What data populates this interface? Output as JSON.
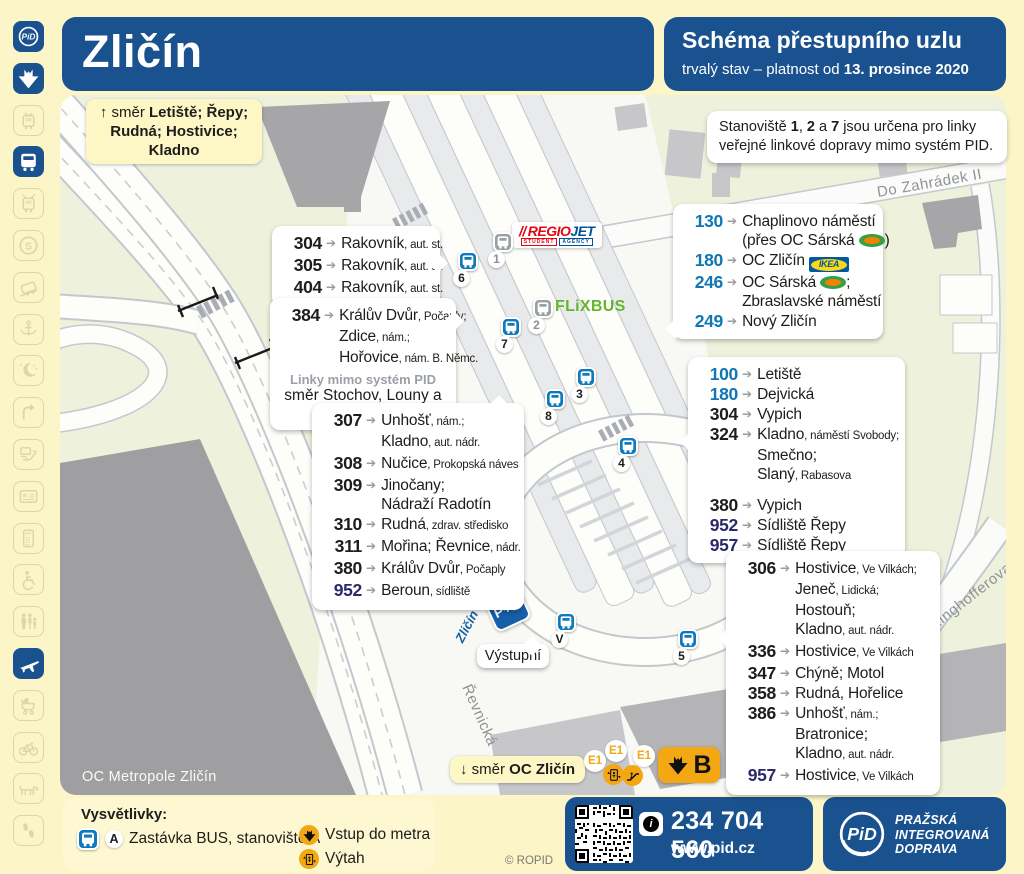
{
  "header": {
    "station": "Zličín",
    "title": "Schéma přestupního uzlu",
    "subtitle_prefix": "trvalý stav – platnost od ",
    "subtitle_date": "13. prosince 2020"
  },
  "sidebar": {
    "icons": [
      {
        "name": "pid-logo-icon",
        "active": true
      },
      {
        "name": "metro-icon",
        "active": true
      },
      {
        "name": "tram-icon",
        "active": false
      },
      {
        "name": "bus-icon",
        "active": true
      },
      {
        "name": "trolleybus-icon",
        "active": false
      },
      {
        "name": "train-icon",
        "active": false
      },
      {
        "name": "funicular-icon",
        "active": false
      },
      {
        "name": "ferry-icon",
        "active": false
      },
      {
        "name": "night-service-icon",
        "active": false
      },
      {
        "name": "turnback-icon",
        "active": false
      },
      {
        "name": "ticket-sale-icon",
        "active": false
      },
      {
        "name": "card-icon",
        "active": false
      },
      {
        "name": "mobile-icon",
        "active": false
      },
      {
        "name": "wheelchair-icon",
        "active": false
      },
      {
        "name": "family-icon",
        "active": false
      },
      {
        "name": "airport-icon",
        "active": true
      },
      {
        "name": "pram-icon",
        "active": false
      },
      {
        "name": "bike-icon",
        "active": false
      },
      {
        "name": "dog-icon",
        "active": false
      },
      {
        "name": "walking-icon",
        "active": false
      }
    ]
  },
  "map": {
    "streets": {
      "do_zahradek": "Do Zahrádek II",
      "ringhofferova": "Ringhofferova",
      "revnicka": "Řevnická"
    },
    "building_label": "OC Metropole Zličín",
    "direction_up": {
      "prefix": "↑ směr ",
      "bold1": "Letiště; Řepy;",
      "bold2": "Rudná; Hostivice; Kladno"
    },
    "direction_down": {
      "prefix": "↓ směr ",
      "bold1": "OC Zličín"
    },
    "note": {
      "line1": [
        {
          "t": "Stanoviště "
        },
        {
          "t": "1",
          "b": 1
        },
        {
          "t": ", "
        },
        {
          "t": "2",
          "b": 1
        },
        {
          "t": " a "
        },
        {
          "t": "7",
          "b": 1
        },
        {
          "t": " jsou určena pro linky"
        }
      ],
      "line2": [
        {
          "t": "veřejné linkové dopravy mimo systém PID."
        }
      ]
    },
    "exit_label": "Výstupní",
    "pr_sign": {
      "label": "P+R",
      "name": "Zličín I."
    },
    "metro_entrance": {
      "line": "B",
      "exit_badges": [
        "E1",
        "E1",
        "E1"
      ]
    },
    "operators": {
      "regiojet": {
        "slashes": "//",
        "part1": "REGIO",
        "part2": "JET",
        "tag1": "STUDENT",
        "tag2": "AGENCY"
      },
      "flixbus": "FLiXBUS",
      "ikea": "IKEA"
    },
    "stops": [
      {
        "label": "6",
        "x": 408,
        "y": 166,
        "variant": "pid"
      },
      {
        "label": "1",
        "x": 443,
        "y": 147,
        "variant": "ext"
      },
      {
        "label": "7",
        "x": 451,
        "y": 232,
        "variant": "pid"
      },
      {
        "label": "2",
        "x": 483,
        "y": 213,
        "variant": "ext"
      },
      {
        "label": "3",
        "x": 526,
        "y": 282,
        "variant": "pid"
      },
      {
        "label": "8",
        "x": 495,
        "y": 304,
        "variant": "pid"
      },
      {
        "label": "4",
        "x": 568,
        "y": 351,
        "variant": "pid"
      },
      {
        "label": "V",
        "x": 506,
        "y": 527,
        "variant": "pid"
      },
      {
        "label": "5",
        "x": 628,
        "y": 544,
        "variant": "pid"
      }
    ],
    "panels": [
      {
        "id": "rakovnik-group",
        "x": 212,
        "y": 131,
        "w": 168,
        "pointer": {
          "side": "right",
          "top": 30
        },
        "routes": [
          {
            "n": "304",
            "c": "sub",
            "lines": [
              [
                {
                  "t": "Rakovník"
                },
                {
                  "t": ", aut. st.",
                  "sm": 1
                }
              ]
            ]
          },
          {
            "n": "305",
            "c": "sub",
            "lines": [
              [
                {
                  "t": "Rakovník"
                },
                {
                  "t": ", aut. st.",
                  "sm": 1
                }
              ]
            ]
          },
          {
            "n": "404",
            "c": "sub",
            "lines": [
              [
                {
                  "t": "Rakovník"
                },
                {
                  "t": ", aut. st.",
                  "sm": 1
                }
              ]
            ]
          }
        ]
      },
      {
        "id": "kraluv-dvur-group",
        "x": 210,
        "y": 203,
        "w": 186,
        "pointer": {
          "side": "right",
          "top": 16
        },
        "routes": [
          {
            "n": "384",
            "c": "sub",
            "lines": [
              [
                {
                  "t": "Králův Dvůr"
                },
                {
                  "t": ", Počaply;",
                  "sm": 1
                }
              ],
              [
                {
                  "t": "Zdice"
                },
                {
                  "t": ", nám.;",
                  "sm": 1
                }
              ],
              [
                {
                  "t": "Hořovice"
                },
                {
                  "t": ", nám. B. Němc.",
                  "sm": 1
                }
              ]
            ]
          }
        ],
        "footnotes": [
          {
            "t": "Linky mimo systém PID",
            "cls": "fn-strong"
          },
          {
            "t": "směr Stochov, Louny a Žatec",
            "cls": "fn-plain"
          }
        ]
      },
      {
        "id": "west-suburban-group",
        "x": 252,
        "y": 308,
        "w": 212,
        "pointer": {
          "side": "top",
          "left": 180
        },
        "routes": [
          {
            "n": "307",
            "c": "sub",
            "lines": [
              [
                {
                  "t": "Unhošť"
                },
                {
                  "t": ", nám.;",
                  "sm": 1
                }
              ],
              [
                {
                  "t": "Kladno"
                },
                {
                  "t": ", aut. nádr.",
                  "sm": 1
                }
              ]
            ]
          },
          {
            "n": "308",
            "c": "sub",
            "lines": [
              [
                {
                  "t": "Nučice"
                },
                {
                  "t": ", Prokopská náves",
                  "sm": 1
                }
              ]
            ]
          },
          {
            "n": "309",
            "c": "sub",
            "lines": [
              [
                {
                  "t": "Jinočany;"
                }
              ],
              [
                {
                  "t": "Nádraží Radotín"
                }
              ]
            ]
          },
          {
            "n": "310",
            "c": "sub",
            "lines": [
              [
                {
                  "t": "Rudná"
                },
                {
                  "t": ", zdrav. středisko",
                  "sm": 1
                }
              ]
            ]
          },
          {
            "n": "311",
            "c": "sub",
            "lines": [
              [
                {
                  "t": "Mořina; Řevnice"
                },
                {
                  "t": ", nádr.",
                  "sm": 1
                }
              ]
            ]
          },
          {
            "n": "380",
            "c": "sub",
            "lines": [
              [
                {
                  "t": "Králův Dvůr"
                },
                {
                  "t": ", Počaply",
                  "sm": 1
                }
              ]
            ]
          },
          {
            "n": "952",
            "c": "night",
            "lines": [
              [
                {
                  "t": "Beroun"
                },
                {
                  "t": ", sídliště",
                  "sm": 1
                }
              ]
            ]
          }
        ]
      },
      {
        "id": "city-lines-north",
        "x": 613,
        "y": 109,
        "w": 210,
        "pointer": {
          "side": "left",
          "top": 118
        },
        "routes": [
          {
            "n": "130",
            "c": "city",
            "lines": [
              [
                {
                  "t": "Chaplinovo náměstí"
                }
              ],
              [
                {
                  "t": "(přes OC Sárská "
                },
                {
                  "logo": "globus"
                },
                {
                  "t": ")"
                }
              ]
            ]
          },
          {
            "n": "180",
            "c": "city",
            "lines": [
              [
                {
                  "t": "OC Zličín "
                },
                {
                  "logo": "ikea"
                }
              ]
            ]
          },
          {
            "n": "246",
            "c": "city",
            "lines": [
              [
                {
                  "t": "OC Sárská "
                },
                {
                  "logo": "globus"
                },
                {
                  "t": ";"
                }
              ],
              [
                {
                  "t": "Zbraslavské náměstí"
                }
              ]
            ]
          },
          {
            "n": "249",
            "c": "city",
            "lines": [
              [
                {
                  "t": "Nový Zličín"
                }
              ]
            ]
          }
        ]
      },
      {
        "id": "city-west-group",
        "x": 628,
        "y": 262,
        "w": 217,
        "pointer": {
          "side": "left",
          "top": 78
        },
        "routes": [
          {
            "n": "100",
            "c": "city",
            "lines": [
              [
                {
                  "t": "Letiště"
                }
              ]
            ]
          },
          {
            "n": "180",
            "c": "city",
            "lines": [
              [
                {
                  "t": "Dejvická"
                }
              ]
            ]
          },
          {
            "n": "304",
            "c": "sub",
            "lines": [
              [
                {
                  "t": "Vypich"
                }
              ]
            ]
          },
          {
            "n": "324",
            "c": "sub",
            "lines": [
              [
                {
                  "t": "Kladno"
                },
                {
                  "t": ", náměstí Svobody;",
                  "sm": 1
                }
              ],
              [
                {
                  "t": "Smečno;"
                }
              ],
              [
                {
                  "t": "Slaný"
                },
                {
                  "t": ", Rabasova",
                  "sm": 1
                }
              ]
            ]
          },
          {
            "n": "380",
            "c": "sub",
            "gap": 1,
            "lines": [
              [
                {
                  "t": "Vypich"
                }
              ]
            ]
          },
          {
            "n": "952",
            "c": "night",
            "lines": [
              [
                {
                  "t": "Sídliště Řepy"
                }
              ]
            ]
          },
          {
            "n": "957",
            "c": "night",
            "lines": [
              [
                {
                  "t": "Sídliště Řepy"
                }
              ]
            ]
          }
        ]
      },
      {
        "id": "south-suburban-group",
        "x": 666,
        "y": 456,
        "w": 214,
        "pointer": {
          "side": "left",
          "top": 80
        },
        "routes": [
          {
            "n": "306",
            "c": "sub",
            "lines": [
              [
                {
                  "t": "Hostivice"
                },
                {
                  "t": ", Ve Vilkách;",
                  "sm": 1
                }
              ],
              [
                {
                  "t": "Jeneč"
                },
                {
                  "t": ", Lidická;",
                  "sm": 1
                }
              ],
              [
                {
                  "t": "Hostouň;"
                }
              ],
              [
                {
                  "t": "Kladno"
                },
                {
                  "t": ", aut. nádr.",
                  "sm": 1
                }
              ]
            ]
          },
          {
            "n": "336",
            "c": "sub",
            "lines": [
              [
                {
                  "t": "Hostivice"
                },
                {
                  "t": ", Ve Vilkách",
                  "sm": 1
                }
              ]
            ]
          },
          {
            "n": "347",
            "c": "sub",
            "lines": [
              [
                {
                  "t": "Chýně; Motol"
                }
              ]
            ]
          },
          {
            "n": "358",
            "c": "sub",
            "lines": [
              [
                {
                  "t": "Rudná, Hořelice"
                }
              ]
            ]
          },
          {
            "n": "386",
            "c": "sub",
            "lines": [
              [
                {
                  "t": "Unhošť"
                },
                {
                  "t": ", nám.;",
                  "sm": 1
                }
              ],
              [
                {
                  "t": "Bratronice;"
                }
              ],
              [
                {
                  "t": "Kladno"
                },
                {
                  "t": ", aut. nádr.",
                  "sm": 1
                }
              ]
            ]
          },
          {
            "n": "957",
            "c": "night",
            "lines": [
              [
                {
                  "t": "Hostivice"
                },
                {
                  "t": ", Ve Vilkách",
                  "sm": 1
                }
              ]
            ]
          }
        ]
      }
    ]
  },
  "legend": {
    "title": "Vysvětlivky:",
    "items": [
      {
        "icon": "bus-stop",
        "badge": "A",
        "label": "Zastávka BUS, stanoviště A"
      },
      {
        "icon": "metro-entrance",
        "label": "Vstup do metra"
      },
      {
        "icon": "elevator",
        "label": "Výtah"
      }
    ]
  },
  "footer": {
    "copyright": "© ROPID",
    "phone": "234 704 560",
    "web": "www.pid.cz",
    "brand": [
      "PRAŽSKÁ",
      "INTEGROVANÁ",
      "DOPRAVA"
    ]
  },
  "colors": {
    "header_blue": "#1a518f",
    "bus_stop_blue": "#0e7abd",
    "non_pid_gray": "#9aa0a5",
    "line_city_blue": "#0f77b5",
    "line_suburban_black": "#1d1d1b",
    "line_night_navy": "#2c2a6b",
    "metro_orange": "#f3a712",
    "flixbus_green": "#64b62d",
    "regiojet_red": "#e30613",
    "regiojet_blue": "#00519e",
    "page_yellow": "#fbf5c8"
  }
}
